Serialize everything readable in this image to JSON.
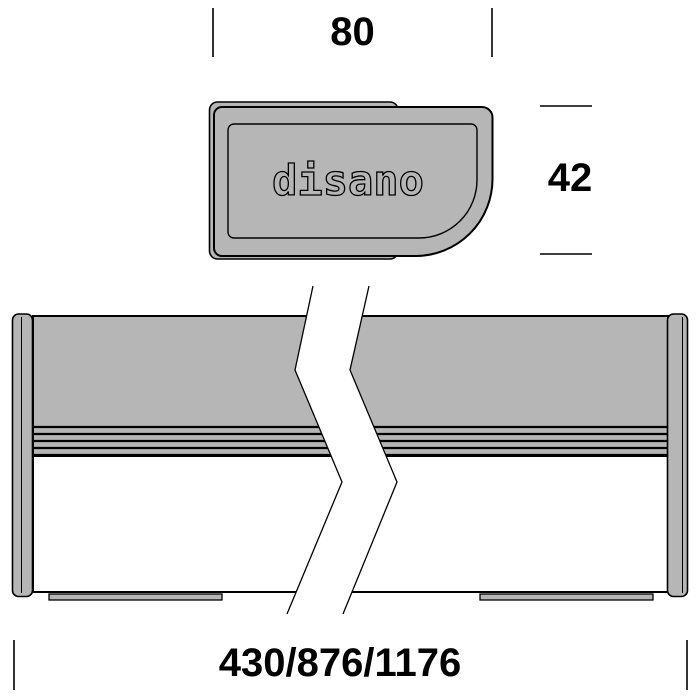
{
  "drawing": {
    "type": "technical-dimension-drawing",
    "brand_logo": "disano",
    "views": {
      "top": "end-cap profile with disano logo",
      "bottom": "side elevation of linear luminaire with break lines"
    },
    "dimensions": {
      "width_top": "80",
      "height_right": "42",
      "length_bottom": "430/876/1176"
    },
    "colors": {
      "body_gray": "#b6b6b6",
      "outline": "#000000",
      "background": "#ffffff"
    }
  }
}
